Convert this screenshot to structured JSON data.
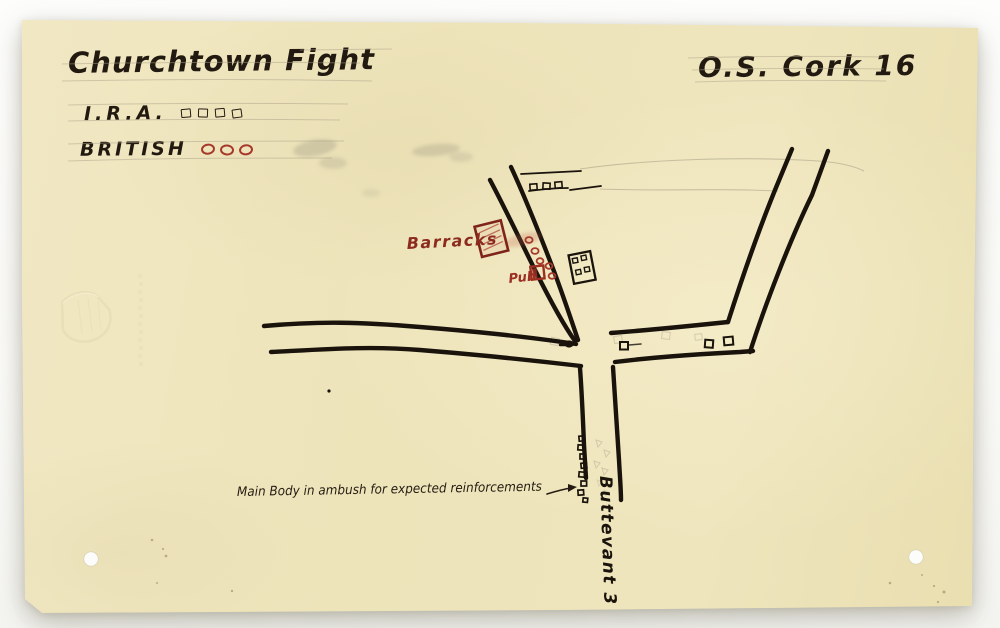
{
  "document": {
    "kind": "scanned hand-drawn military sketch map on aged paper",
    "title": "Churchtown Fight",
    "map_ref": "O.S. Cork 16"
  },
  "legend": {
    "ira": {
      "label": "I.R.A.",
      "symbol": "open-square",
      "count": 4,
      "color": "#221a10"
    },
    "british": {
      "label": "BRITISH",
      "symbol": "open-circle",
      "count": 3,
      "color": "#a6392b"
    }
  },
  "map": {
    "barracks_label": "Barracks",
    "pub_label": "Pub",
    "ambush_note": "Main Body in ambush for expected reinforcements",
    "road_sign": "Buttevant 3",
    "marker_counts": {
      "lane_ira_squares": 3,
      "junction_ira_squares": 4,
      "ambush_column_squares": 8,
      "british_sentry_circles": 5
    },
    "colors": {
      "ink": "#19130c",
      "red_ink": "#9c2f22",
      "paper": "#efe6bf",
      "pencil": "#a79e85"
    }
  }
}
